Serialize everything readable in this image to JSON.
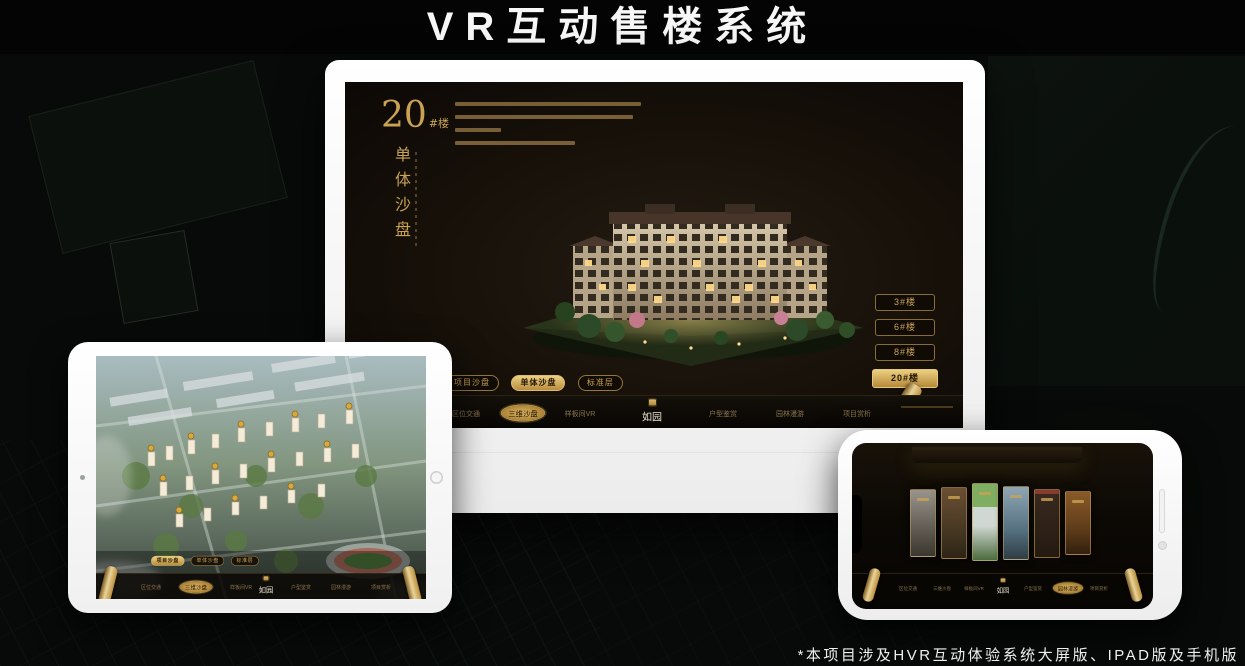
{
  "title": "VR互动售楼系统",
  "footnote": "*本项目涉及HVR互动体验系统大屏版、IPAD版及手机版",
  "brand": {
    "logo": "如园"
  },
  "colors": {
    "gold": "#C9A254",
    "gold_bright": "#E8C87A",
    "screen_bg": "#171109"
  },
  "tabs": [
    "项目沙盘",
    "单体沙盘",
    "标准层"
  ],
  "nav_items": [
    "区位交通",
    "三维沙盘",
    "样板间VR",
    "户型鉴赏",
    "园林漫游",
    "项目赏析"
  ],
  "desktop_screen": {
    "building_number": "20",
    "building_number_suffix": "#楼",
    "section_title_vertical": "单体沙盘",
    "floor_buttons": [
      "3#楼",
      "6#楼",
      "8#楼",
      "20#楼"
    ],
    "active_floor_button": "20#楼",
    "active_tab": "单体沙盘",
    "active_nav_item": "三维沙盘"
  },
  "tablet_screen": {
    "active_tab": "项目沙盘",
    "active_nav_item": "三维沙盘"
  },
  "phone_screen": {
    "active_nav_item": "园林漫游"
  }
}
